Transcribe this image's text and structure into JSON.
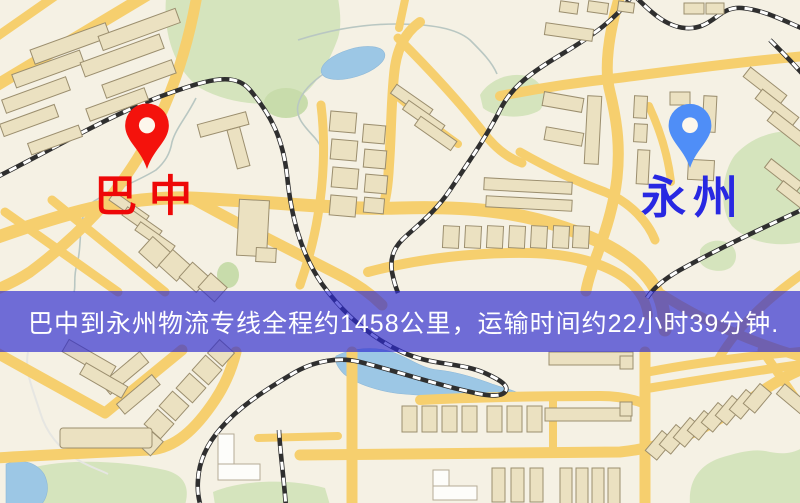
{
  "markers": {
    "origin": {
      "label": "巴中"
    },
    "destination": {
      "label": "永州"
    }
  },
  "banner": {
    "text": "巴中到永州物流专线全程约1458公里，运输时间约22小时39分钟."
  },
  "colors": {
    "map_bg": "#f5f1e4",
    "park": "#d5e4bd",
    "water": "#9cc7e5",
    "road": "#f6cf6e",
    "building": "#ebe1c1",
    "building_stroke": "#9b8e6e",
    "railway": "#2f2f2f",
    "origin_pin": "#f4120c",
    "origin_label": "#ee0808",
    "destination_pin": "#4f8ef7",
    "destination_label": "#2828e2",
    "banner_bg": "rgba(45,42,208,0.67)",
    "banner_text": "#ffffff"
  }
}
